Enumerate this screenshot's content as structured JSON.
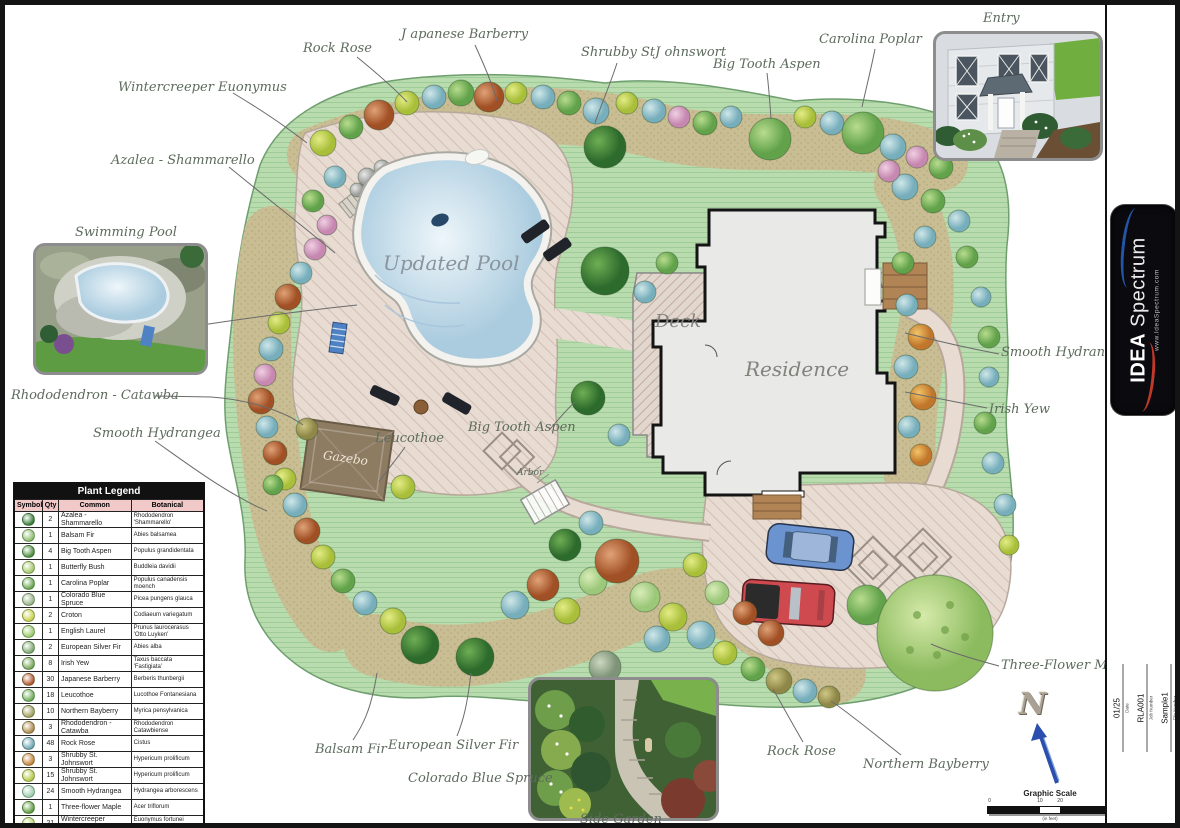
{
  "annotations": [
    {
      "text": "Wintercreeper Euonymus"
    },
    {
      "text": "Rock Rose"
    },
    {
      "text": "J apanese Barberry"
    },
    {
      "text": "Shrubby StJ ohnswort"
    },
    {
      "text": "Big Tooth Aspen"
    },
    {
      "text": "Carolina Poplar"
    },
    {
      "text": "Entry"
    },
    {
      "text": "Azalea - Shammarello"
    },
    {
      "text": "Swimming Pool"
    },
    {
      "text": "Rhododendron - Catawba"
    },
    {
      "text": "Smooth Hydrangea"
    },
    {
      "text": "Leucothoe"
    },
    {
      "text": "Big Tooth Aspen"
    },
    {
      "text": "Arbor"
    },
    {
      "text": "Smooth Hydrangea"
    },
    {
      "text": "Irish Yew"
    },
    {
      "text": "Three-Flower Maple"
    },
    {
      "text": "Balsam Fir"
    },
    {
      "text": "European Silver Fir"
    },
    {
      "text": "Colorado Blue Spruce"
    },
    {
      "text": "Side Garden"
    },
    {
      "text": "Rock Rose"
    },
    {
      "text": "Northern Bayberry"
    }
  ],
  "area_labels": {
    "pool": "Updated Pool",
    "deck": "Deck",
    "residence": "Residence",
    "gazebo": "Gazebo"
  },
  "legend": {
    "title": "Plant Legend",
    "columns": [
      "Symbol",
      "Qty",
      "Common",
      "Botanical"
    ],
    "rows": [
      {
        "qty": "2",
        "common": "Azalea - Shammarello",
        "botanical": "Rhododendron 'Shammarello'",
        "color": "#3a7d3a"
      },
      {
        "qty": "1",
        "common": "Balsam Fir",
        "botanical": "Abies balsamea",
        "color": "#8fbf6f"
      },
      {
        "qty": "4",
        "common": "Big Tooth Aspen",
        "botanical": "Populus grandidentata",
        "color": "#4e8f3e"
      },
      {
        "qty": "1",
        "common": "Butterfly Bush",
        "botanical": "Buddleia davidii",
        "color": "#a7c96a"
      },
      {
        "qty": "1",
        "common": "Carolina Poplar",
        "botanical": "Populus canadensis moench",
        "color": "#6aa84f"
      },
      {
        "qty": "1",
        "common": "Colorado Blue Spruce",
        "botanical": "Picea pungens glauca",
        "color": "#9ab58a"
      },
      {
        "qty": "2",
        "common": "Croton",
        "botanical": "Codiaeum variegatum",
        "color": "#cdd24a"
      },
      {
        "qty": "1",
        "common": "English Laurel",
        "botanical": "Prunus laurocerasus 'Otto Luyken'",
        "color": "#9ccb6a"
      },
      {
        "qty": "2",
        "common": "European Silver Fir",
        "botanical": "Abies alba",
        "color": "#7fa96f"
      },
      {
        "qty": "8",
        "common": "Irish Yew",
        "botanical": "Taxus baccata 'Fastigiata'",
        "color": "#79a85a"
      },
      {
        "qty": "30",
        "common": "Japanese Barberry",
        "botanical": "Berberis thunbergii",
        "color": "#b3592f"
      },
      {
        "qty": "18",
        "common": "Leucothoe",
        "botanical": "Lucothoe Fontanesiana",
        "color": "#6fae5a"
      },
      {
        "qty": "10",
        "common": "Northern Bayberry",
        "botanical": "Myrica pensylvanica",
        "color": "#a5a05c"
      },
      {
        "qty": "3",
        "common": "Rhododendron - Catawba",
        "botanical": "Rhododendron Catawbiense",
        "color": "#b08a4a"
      },
      {
        "qty": "48",
        "common": "Rock Rose",
        "botanical": "Cistus",
        "color": "#6fa8b8"
      },
      {
        "qty": "3",
        "common": "Shrubby St. Johnswort",
        "botanical": "Hypericum prolificum",
        "color": "#c7853d"
      },
      {
        "qty": "15",
        "common": "Shrubby St. Johnswort",
        "botanical": "Hypericum prolificum",
        "color": "#b9c947"
      },
      {
        "qty": "24",
        "common": "Smooth Hydrangea",
        "botanical": "Hydrangea arborescens",
        "color": "#9fd0b0"
      },
      {
        "qty": "1",
        "common": "Three-flower Maple",
        "botanical": "Acer triflorum",
        "color": "#5f9e3f"
      },
      {
        "qty": "21",
        "common": "Wintercreeper Euonymus",
        "botanical": "Euonymus fortunei 'Emerald n Gold'",
        "color": "#b9d96a"
      }
    ]
  },
  "north_label": "N",
  "graphic_scale": {
    "title": "Graphic Scale",
    "ticks": [
      "0",
      "10",
      "20",
      "40"
    ],
    "units": "(in feet)"
  },
  "title_block": {
    "sheet_title": {
      "value": "Sample Landscape 1",
      "label": "Sheet Title"
    },
    "website": {
      "value": "IdeaSpectrum.com",
      "label": "Website"
    },
    "firm": {
      "value": "Idea Spectrum",
      "label": "Firm"
    },
    "designer": {
      "value": "Justin Napier",
      "label": "Designed By"
    },
    "logo": {
      "brand_bold": "IDEA",
      "brand_rest": " Spectrum",
      "url": "www.IdeaSpectrum.com",
      "accent_red": "#c0392b",
      "accent_blue": "#2456a8"
    },
    "product": {
      "line1": "Realtime Landscaping",
      "line2": "Architect"
    },
    "date": {
      "value": "01/25",
      "label": "Date"
    },
    "job": {
      "value": "RLA001",
      "label": "Job Number"
    },
    "file": {
      "value": "Sample1",
      "label": "File Number"
    },
    "sheet_no": {
      "line1": "Sheet",
      "line2": "1 of 1"
    }
  }
}
